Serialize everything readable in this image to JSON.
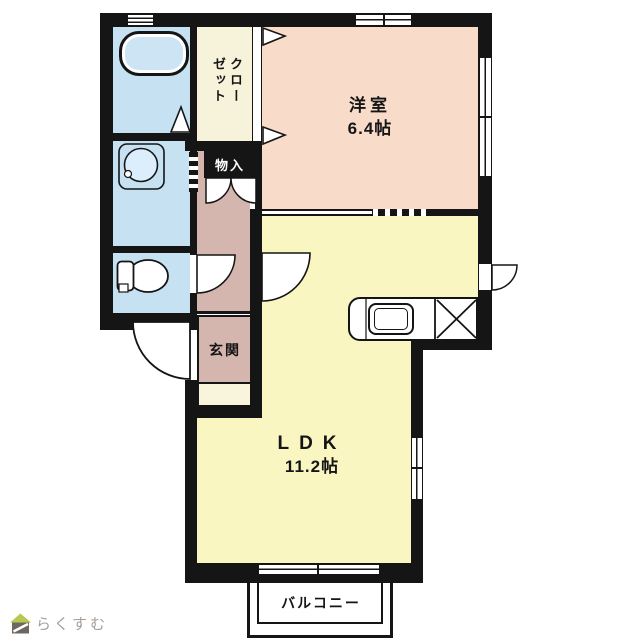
{
  "floor_plan": {
    "rooms": {
      "western_room": {
        "label": "洋室",
        "size": "6.4帖"
      },
      "ldk": {
        "label": "LDK",
        "size": "11.2帖"
      },
      "closet": {
        "label": "クローゼット"
      },
      "storage": {
        "label": "物入"
      },
      "entrance": {
        "label": "玄関"
      },
      "balcony": {
        "label": "バルコニー"
      }
    },
    "icons": {
      "bathtub": "bathtub-icon",
      "washbasin": "washbasin-icon",
      "toilet": "toilet-icon",
      "kitchen_sink": "kitchen-sink-icon",
      "stove_cross": "stove-cross-icon",
      "logo_house": "house-icon"
    },
    "colors": {
      "wall": "#151515",
      "western_room": "#f8dcc9",
      "ldk": "#f9f6c2",
      "closet": "#f7f2da",
      "hallway_entrance": "#d5b6ae",
      "sanitary": "#c6e1f2",
      "nook": "#f8f5dc",
      "logo_green": "#b7c94c",
      "logo_body": "#6e6761",
      "logo_text": "#a79e97"
    }
  },
  "footer": {
    "logo_text": "らくすむ"
  }
}
